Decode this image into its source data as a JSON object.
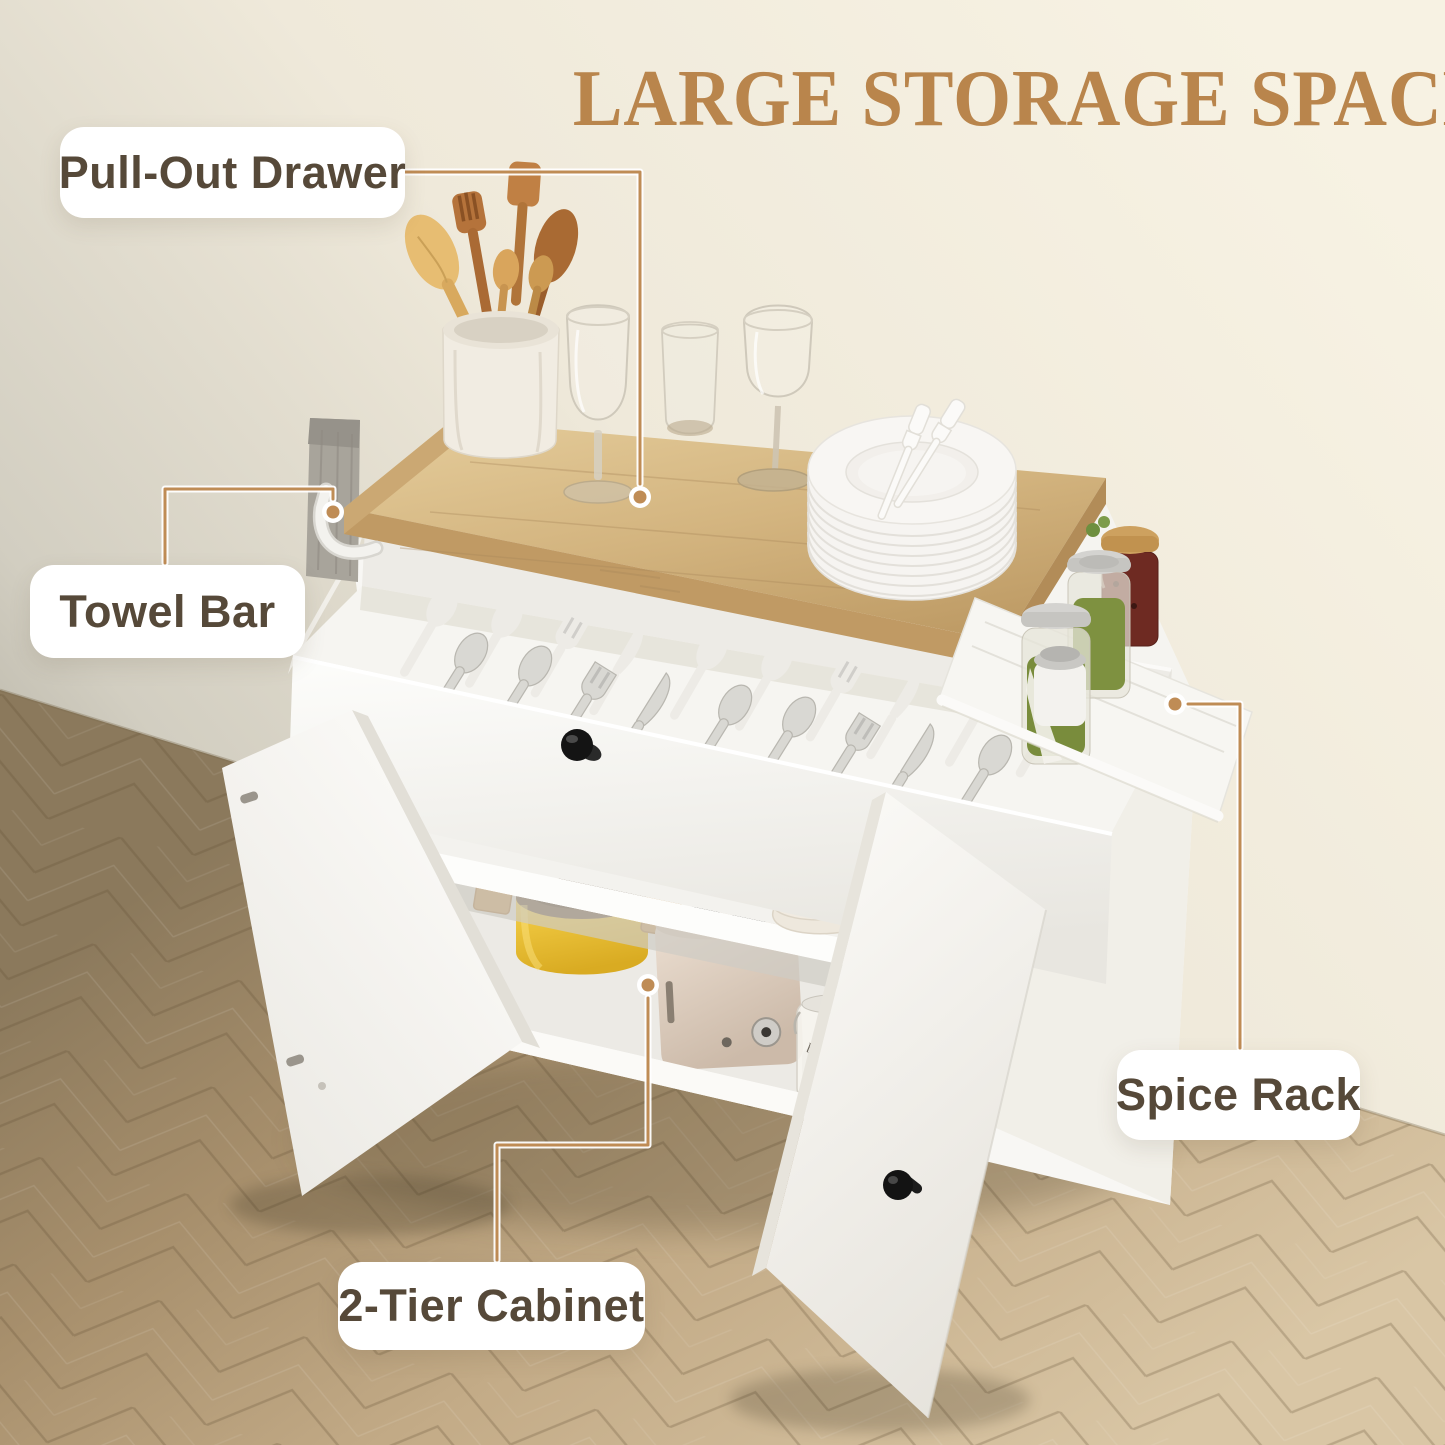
{
  "title": {
    "text": "LARGE STORAGE SPACE"
  },
  "callouts": {
    "pull_out_drawer": {
      "label": "Pull-Out Drawer"
    },
    "towel_bar": {
      "label": "Towel Bar"
    },
    "spice_rack": {
      "label": "Spice Rack"
    },
    "two_tier_cabinet": {
      "label": "2-Tier Cabinet"
    }
  },
  "scene": {
    "product": "rolling-kitchen-island-cart",
    "jar_labels": {
      "flour": "flour",
      "baking_soda": "baking soda"
    },
    "objects": [
      "wood-countertop",
      "utensil-crock",
      "wooden-utensils",
      "wine-glasses",
      "stacked-plates",
      "cutlery-drawer",
      "drawer-knob",
      "towel-bar",
      "towel",
      "spice-rack",
      "spice-jars",
      "left-cabinet-door",
      "right-cabinet-door",
      "middle-shelf",
      "bottom-shelf",
      "yellow-pot",
      "toaster",
      "storage-jars",
      "caster-wheels",
      "herringbone-floor"
    ]
  },
  "colors": {
    "title": "#b9854c",
    "label_text": "#564939",
    "label_bg": "#ffffff",
    "callout_line": "#bf8c55",
    "wood": "#d3b47f",
    "cart_white": "#f8f7f4",
    "wall": "#f2edde",
    "floor": "#c3ab87",
    "pot_yellow": "#f0c93c",
    "knob_black": "#181818",
    "towel_gray": "#a8a49b"
  }
}
